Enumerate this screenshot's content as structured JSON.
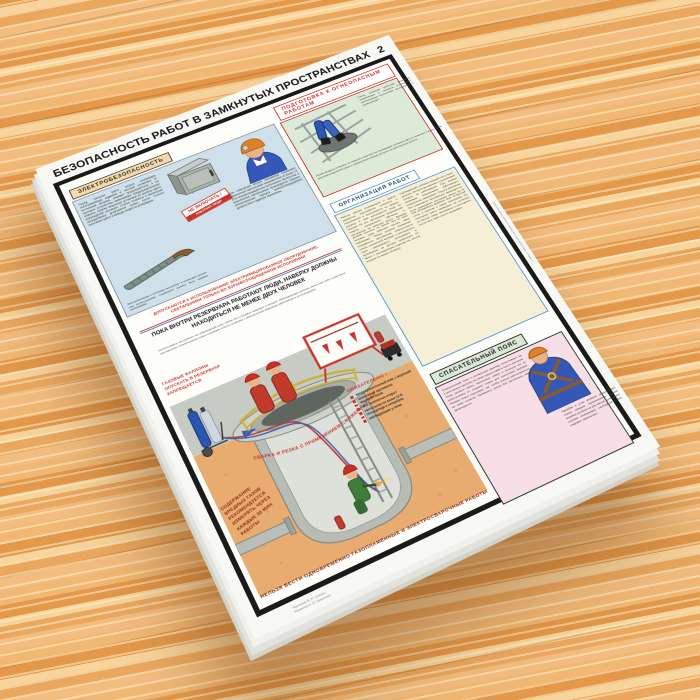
{
  "page_number": "2",
  "poster": {
    "title": "БЕЗОПАСНОСТЬ РАБОТ В ЗАМКНУТЫХ ПРОСТРАНСТВАХ",
    "credits": {
      "line1": "Художник В. П. Силкин",
      "line2": "Редактор А. И. Смирнова"
    },
    "imprint": "Безопасность работ в замкнутых пространствах. Плакат 2",
    "colors": {
      "accent_red": "#c9342a",
      "panel_blue": "#cfe0ea",
      "panel_mint": "#dcead8",
      "panel_cream": "#f4efd5",
      "panel_pink": "#f8dfe7",
      "frame_black": "#1a1a1a",
      "soil_orange": "#e8ab70",
      "wood_orange": "#eeb06f"
    },
    "sections": {
      "electro": {
        "title": "ЭЛЕКТРОБЕЗОПАСНОСТЬ",
        "text1": "Перед началом работ внутри резервуара электроприводы задвижек и насосов отключают от источников питания, снимают предохранители, а на пусковых устройствах вывешивают предупредительные плакаты. Кабели сварочных установок не должны иметь повреждений изоляции. Снятие плакатов и включение оборудования допускается только после полного окончания работ и вывода людей из резервуара.",
        "text2": "Для освещения внутри резервуара применяют переносные светильники напряжением не выше 12 В во взрывозащищённом исполнении. Включение и выключение светильников производится снаружи. Металлические корпуса электрооборудования должны быть надёжно заземлены.",
        "cable_caption": "Электропроводку к установке выполняют в резиновом шланге или металлорукаве; соединения должны быть надёжно изолированы.",
        "tag_line1": "НЕ ВКЛЮЧАТЬ !",
        "tag_line2": "РАБОТАЮТ ЛЮДИ"
      },
      "warning_equipment": "ДОПУСКАЮТСЯ К ИСПОЛЬЗОВАНИЮ ЭЛЕКТРИФИЦИРОВАННОЕ ОБОРУДОВАНИЕ, СВЕТИЛЬНИКИ ТОЛЬКО ВО ВЗРЫВОЗАЩИЩЕННОМ ИСПОЛНЕНИИ",
      "banner": "ПОКА ВНУТРИ РЕЗЕРВУАРА РАБОТАЮТ ЛЮДИ, НАВЕРХУ ДОЛЖНЫ НАХОДИТЬСЯ НЕ МЕНЕЕ ДВУХ ЧЕЛОВЕК",
      "banner_note": "Использовать инструмент, не образующий искр, обувь без стальных подковок и гвоздей. Наблюдающие должны иметь при себе шланговые противогазы, спасательные пояса и верёвки и быть готовыми к немедленной эвакуации работающего из резервуара.",
      "podgotovka": {
        "title": "ПОДГОТОВКА К ОГНЕОПАСНЫМ РАБОТАМ",
        "text": "Перед огневыми работами резервуар освобождают от продукта, отсоединяют трубопроводы заглушками, пропаривают и проветривают.",
        "text2": "Пробы воздуха отбирают из нижней и верхней зон резервуара. Огневые работы начинают только после анализа воздушной среды и оформления наряда-допуска на газоопасные работы."
      },
      "organizacija": {
        "title": "ОРГАНИЗАЦИЯ РАБОТ",
        "col1": "Работы внутри резервуаров и других замкнутых пространств относятся к газоопасным и выполняются по наряду-допуску. К ним допускаются лица не моложе 18 лет, прошедшие медицинский осмотр, специальное обучение и инструктаж на рабочем месте. Бригада должна состоять не менее чем из трёх человек: один работает внутри, двое наблюдают. Перед спуском проверяют исправность противогаза, спасательного пояса, сигнальной верёвки и инструмента. Срок одноразового пребывания в противогазе не должен превышать 15 минут с последующим отдыхом на чистом воздухе не менее 15 минут.",
        "col2": "Наблюдающие обязаны находиться у люка, держать сигнальную верёвку и непрерывно следить за работающим. При первых признаках недомогания работающего немедленно эвакуируют. Спуск в резервуар без шлангового противогаза запрещается, если содержание кислорода менее 20 % или обнаружены вредные газы. Открытый огонь и курение у люков запрещены. По окончании работ проверяют, не остались ли внутри люди, материалы и инструмент, после чего люки плотно закрывают."
      },
      "pojas": {
        "title": "СПАСАТЕЛЬНЫЙ ПОЯС",
        "col1": "Спасательный пояс и сигнальную верёвку испытывают на статическую нагрузку не реже одного раза в шесть месяцев. Пояс должен иметь наплечные лямки с кольцом на их пересечении со стороны спины для крепления верёвки. Размер пояса подгоняют так, чтобы кольцо располагалось не ниже лопаток. Применять пояса без наплечных лямок запрещается.",
        "col2": "Карабин и узлы верёвки осматривают перед каждым применением. Длина верёвки должна на два метра превышать глубину резервуара; свободный конец надёжно закрепляют."
      },
      "illustration": {
        "gas_cylinders_warning": "ГАЗОВЫЕ БАЛЛОНЫ ОПУСКАТЬ В РЕЗЕРВУАР ЗАПРЕЩАЕТСЯ",
        "welding_warning": "СВАРКА И РЕЗКА С ПРИМЕНЕНИЕМ СЖИЖЕННЫХ ГАЗОВ НЕДОПУСТИМЫ",
        "gas_measure_note": "СОДЕРЖАНИЕ ВРЕДНЫХ ГАЗОВ РЕКОМЕНДУЕТСЯ ИЗМЕРЯТЬ ЧЕРЕЗ КАЖДЫЕ 30 МИН РАБОТЫ",
        "mandatory_title": "ОБЯЗАТЕЛЬНО !",
        "mandatory_items": [
          "предохранительный пояс с верёвкой",
          "шланговый противогаз",
          "защитная каска",
          "люк полностью открыт",
          "светильник не выше 12 В",
          "спецодежда и спецобувь",
          "наблюдающие у люка"
        ],
        "bottom_warning": "НЕЛЬЗЯ ВЕСТИ ОДНОВРЕМЕННО ГАЗОПЛАМЕННЫЕ И ЭЛЕКТРОСВАРОЧНЫЕ РАБОТЫ"
      }
    }
  }
}
